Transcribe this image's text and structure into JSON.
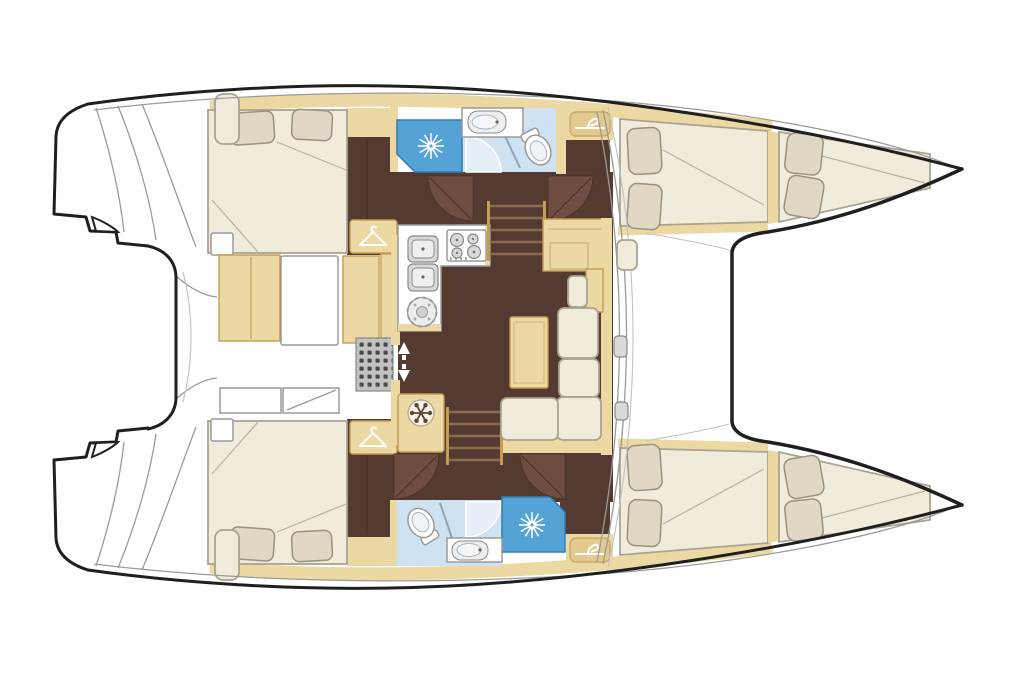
{
  "meta": {
    "title": "Catamaran sailing yacht accommodation floor plan",
    "view": "top-down deck plan",
    "orientation": "bow pointing right, twin hulls top and bottom",
    "visible_text": "none"
  },
  "palette": {
    "background": "#ffffff",
    "hull_outline": "#1f1f1f",
    "line_gray": "#9a9a9a",
    "line_light": "#c2c2c2",
    "tan": "#ecd8a2",
    "tan_border": "#c49c52",
    "tan_dark": "#e3c98e",
    "floor_brown": "#543a30",
    "door_brown": "#6f4d42",
    "door_edge": "#46302a",
    "stair_line": "#8d6b53",
    "cream": "#f1ebdc",
    "cream_border": "#a9a392",
    "pillow": "#e0d8c4",
    "pillow_border": "#98927f",
    "shower_blue": "#55a2d6",
    "shower_border": "#2e7cb0",
    "bath_floor": "#cfe2f1",
    "white": "#ffffff",
    "appliance": "#d9d9d9",
    "appliance_edge": "#8a8a8a",
    "grate": "#c2c2c2",
    "grate_dot": "#4b4b4b",
    "fridge_disc": "#f8f3e4",
    "snowflake": "#5f4437"
  },
  "labels": {
    "vessel": "Catamaran yacht floor plan, bow to the right",
    "top_hull": "Upper hull: aft double cabin with hanging locker, bathroom with shower, washbasin and toilet, forward double cabin and bow berth",
    "bottom_hull": "Lower hull: aft double cabin with hanging locker, bathroom with shower, washbasin and toilet, forward double cabin and bow berth",
    "salon": "Central salon: U-shaped galley with twin sinks, four-burner stove and refrigerator, L-shaped sofa with table, nav cabinet, twin companionway stairs and four cabin doors",
    "cockpit": "Aft cockpit with cushioned bench, table, deck grating and stowage lockers",
    "foredeck": "Foredeck with trampoline frame between the bows"
  },
  "icons": [
    {
      "name": "shower-starburst-icon",
      "meaning": "shower head",
      "count": 2
    },
    {
      "name": "hanger-icon",
      "meaning": "hanging locker / wardrobe",
      "count": 4
    },
    {
      "name": "snowflake-icon",
      "meaning": "refrigerator",
      "count": 1
    },
    {
      "name": "slide-arrows-icon",
      "meaning": "sliding salon entry door",
      "count": 1
    },
    {
      "name": "stove-burners-icon",
      "meaning": "4-burner hob",
      "count": 1
    },
    {
      "name": "sink-icon",
      "meaning": "galley and bathroom sinks",
      "count": 5
    },
    {
      "name": "toilet-icon",
      "meaning": "marine toilet",
      "count": 2
    }
  ],
  "vessel": {
    "type": "catamaran",
    "cabins": 4,
    "bathrooms": 2,
    "berth_areas": 6,
    "features": [
      "aft cockpit with bench and table",
      "salon with U-galley",
      "L-shaped sofa with table",
      "twin companionway stairs",
      "trampoline foredeck",
      "transom boarding steps"
    ]
  }
}
